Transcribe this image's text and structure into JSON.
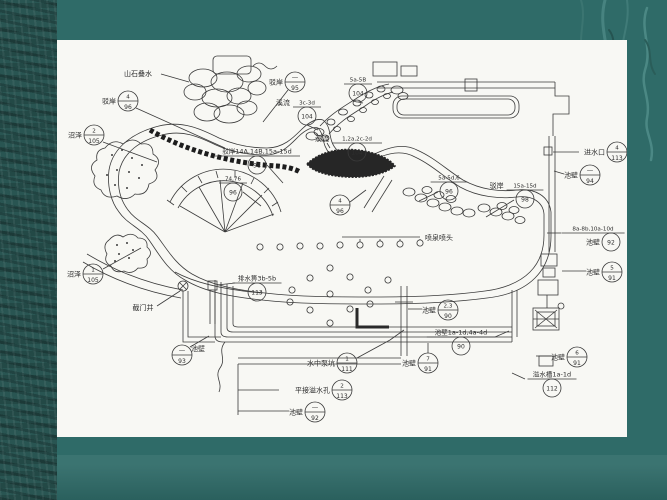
{
  "slide": {
    "background_color": "#2f6b68",
    "left_strip_color": "#295552",
    "panel_color": "#f8f8f4",
    "line_color": "#3b3b3b"
  },
  "drawing": {
    "plain_labels": [
      {
        "id": "rock-cascade-label",
        "text": "山石叠水",
        "x": 81,
        "y": 36,
        "leader": [
          [
            104,
            34
          ],
          [
            132,
            42
          ]
        ]
      },
      {
        "id": "valve-well-label",
        "text": "截门井",
        "x": 86,
        "y": 270,
        "leader": [
          [
            100,
            266
          ],
          [
            123,
            251
          ]
        ]
      },
      {
        "id": "fountain-heads-label",
        "text": "喷泉喷头",
        "x": 382,
        "y": 200,
        "leader": [
          [
            363,
            197
          ],
          [
            285,
            197
          ]
        ]
      }
    ],
    "callouts": [
      {
        "id": "boan-4-96",
        "style": "c",
        "prefix": "驳岸",
        "top": "4",
        "bottom": "96",
        "x": 71,
        "y": 61,
        "leader": [
          [
            79,
            68
          ],
          [
            168,
            108
          ]
        ]
      },
      {
        "id": "zhaoze-2-105",
        "style": "c",
        "prefix": "沼泽",
        "top": "2",
        "bottom": "105",
        "x": 37,
        "y": 95,
        "leader": [
          [
            46,
            102
          ],
          [
            100,
            122
          ]
        ]
      },
      {
        "id": "zhaoze-1-105",
        "style": "c",
        "prefix": "沼泽",
        "top": "1",
        "bottom": "105",
        "x": 36,
        "y": 234,
        "leader": [
          [
            46,
            229
          ],
          [
            84,
            208
          ]
        ]
      },
      {
        "id": "boan-x-95",
        "style": "c",
        "prefix": "驳岸",
        "top": "—",
        "bottom": "95",
        "x": 238,
        "y": 42,
        "leader": [
          [
            231,
            50
          ],
          [
            206,
            82
          ]
        ]
      },
      {
        "id": "ref-5a5b-104",
        "style": "w",
        "prefix": "",
        "top": "5a-5B",
        "bottom": "104",
        "x": 301,
        "y": 44,
        "leader": [
          [
            301,
            62
          ],
          [
            306,
            63
          ]
        ]
      },
      {
        "id": "xiliu-3c3d-104",
        "style": "w",
        "prefix": "溪流",
        "top": "3c-3d",
        "bottom": "104",
        "x": 250,
        "y": 67,
        "leader": [
          [
            250,
            85
          ],
          [
            261,
            90
          ]
        ]
      },
      {
        "id": "xiliu-2a2d-104",
        "style": "w",
        "prefix": "溪流",
        "top": "1,2a,2c-2d",
        "bottom": "104",
        "x": 300,
        "y": 103,
        "leader": [
          [
            270,
            103
          ],
          [
            273,
            108
          ]
        ]
      },
      {
        "id": "boan-14-98",
        "style": "w",
        "prefix": "",
        "top": "驳岸14A,14B,15a-15d",
        "bottom": "98",
        "x": 200,
        "y": 116,
        "leader": [
          [
            210,
            125
          ],
          [
            226,
            143
          ]
        ]
      },
      {
        "id": "ref-7476-96",
        "style": "w",
        "prefix": "",
        "top": "74,76",
        "bottom": "96",
        "x": 176,
        "y": 143,
        "leader": [
          [
            186,
            152
          ],
          [
            204,
            166
          ]
        ]
      },
      {
        "id": "ref-4-96",
        "style": "c",
        "prefix": "",
        "top": "4",
        "bottom": "96",
        "x": 283,
        "y": 165,
        "leader": [
          [
            293,
            162
          ],
          [
            309,
            150
          ]
        ]
      },
      {
        "id": "ref-5a5d6-96",
        "style": "w",
        "prefix": "",
        "top": "5a-5d,6",
        "bottom": "96",
        "x": 392,
        "y": 142,
        "leader": [
          [
            381,
            152
          ],
          [
            362,
            161
          ]
        ]
      },
      {
        "id": "boan-15a15d-98",
        "style": "w",
        "prefix": "驳岸",
        "top": "15a-15d",
        "bottom": "98",
        "x": 468,
        "y": 150,
        "leader": [
          [
            457,
            160
          ],
          [
            429,
            177
          ]
        ]
      },
      {
        "id": "jinshuikou-4-113",
        "style": "c",
        "prefix": "进水口",
        "top": "4",
        "bottom": "113",
        "x": 560,
        "y": 112,
        "leader": [
          [
            522,
            112
          ],
          [
            496,
            112
          ]
        ]
      },
      {
        "id": "chibi-x-94",
        "style": "c",
        "prefix": "池壁",
        "top": "—",
        "bottom": "94",
        "x": 533,
        "y": 135,
        "leader": [
          [
            507,
            134
          ],
          [
            497,
            131
          ]
        ]
      },
      {
        "id": "chibi-8a10d-92",
        "style": "wb",
        "prefix": "池壁",
        "top": "8a-8b,10a-10d",
        "bottom": "92",
        "x": 536,
        "y": 193,
        "leader": [
          [
            504,
            193
          ],
          [
            490,
            193
          ]
        ]
      },
      {
        "id": "chibi-5-91",
        "style": "c",
        "prefix": "池壁",
        "top": "5",
        "bottom": "91",
        "x": 555,
        "y": 232,
        "leader": [
          [
            529,
            231
          ],
          [
            505,
            231
          ]
        ]
      },
      {
        "id": "chibi-23-90",
        "style": "c",
        "prefix": "池壁",
        "top": "2,3",
        "bottom": "90",
        "x": 391,
        "y": 270,
        "leader": [
          [
            365,
            269
          ],
          [
            351,
            269
          ]
        ]
      },
      {
        "id": "chibi-1a4d-90",
        "style": "w",
        "prefix": "",
        "top": "池壁1a-1d,4a-4d",
        "bottom": "90",
        "x": 404,
        "y": 297,
        "leader": [
          [
            438,
            297
          ],
          [
            452,
            291
          ]
        ]
      },
      {
        "id": "chibi-7-91",
        "style": "c",
        "prefix": "池壁",
        "top": "7",
        "bottom": "91",
        "x": 371,
        "y": 323,
        "leader": [
          [
            371,
            313
          ],
          [
            371,
            303
          ]
        ]
      },
      {
        "id": "chibi-6-91",
        "style": "c",
        "prefix": "池壁",
        "top": "6",
        "bottom": "91",
        "x": 520,
        "y": 317,
        "leader": [
          [
            494,
            316
          ],
          [
            479,
            316
          ]
        ]
      },
      {
        "id": "yishuicao-1a1d-112",
        "style": "w",
        "prefix": "",
        "top": "溢水槽1a-1d",
        "bottom": "112",
        "x": 495,
        "y": 339,
        "leader": [
          [
            468,
            339
          ],
          [
            455,
            333
          ]
        ]
      },
      {
        "id": "bengkeng-1-111",
        "style": "c",
        "prefix": "水中泵坑",
        "top": "1",
        "bottom": "111",
        "x": 290,
        "y": 323,
        "leader": [
          [
            300,
            318
          ],
          [
            333,
            300
          ],
          [
            347,
            290
          ]
        ]
      },
      {
        "id": "yishuikong-2-113",
        "style": "c",
        "prefix": "平接溢水孔",
        "top": "2",
        "bottom": "113",
        "x": 285,
        "y": 350,
        "leader": [
          [
            222,
            350
          ],
          [
            181,
            350
          ]
        ]
      },
      {
        "id": "chibi-x-92",
        "style": "c",
        "prefix": "池壁",
        "top": "—",
        "bottom": "92",
        "x": 258,
        "y": 372,
        "leader": [
          [
            232,
            371
          ],
          [
            181,
            371
          ]
        ]
      },
      {
        "id": "chibi-x-93",
        "style": "c",
        "prefix": "池壁",
        "top": "—",
        "bottom": "93",
        "x": 125,
        "y": 315,
        "prefix_side": "right",
        "leader": [
          [
            133,
            307
          ],
          [
            152,
            296
          ]
        ]
      },
      {
        "id": "paishuibi-3b5b-113",
        "style": "w",
        "prefix": "",
        "top": "排水箅3b-5b",
        "bottom": "113",
        "x": 200,
        "y": 243,
        "leader": [
          [
            178,
            243
          ],
          [
            160,
            245
          ]
        ]
      }
    ],
    "fountain_jets": [
      [
        203,
        207
      ],
      [
        223,
        207
      ],
      [
        243,
        206
      ],
      [
        263,
        206
      ],
      [
        283,
        205
      ],
      [
        303,
        205
      ],
      [
        323,
        204
      ],
      [
        343,
        204
      ],
      [
        363,
        203
      ],
      [
        273,
        228
      ],
      [
        253,
        238
      ],
      [
        293,
        237
      ],
      [
        235,
        250
      ],
      [
        273,
        254
      ],
      [
        311,
        250
      ],
      [
        253,
        270
      ],
      [
        293,
        269
      ],
      [
        273,
        283
      ],
      [
        233,
        262
      ],
      [
        313,
        264
      ],
      [
        331,
        240
      ]
    ]
  }
}
